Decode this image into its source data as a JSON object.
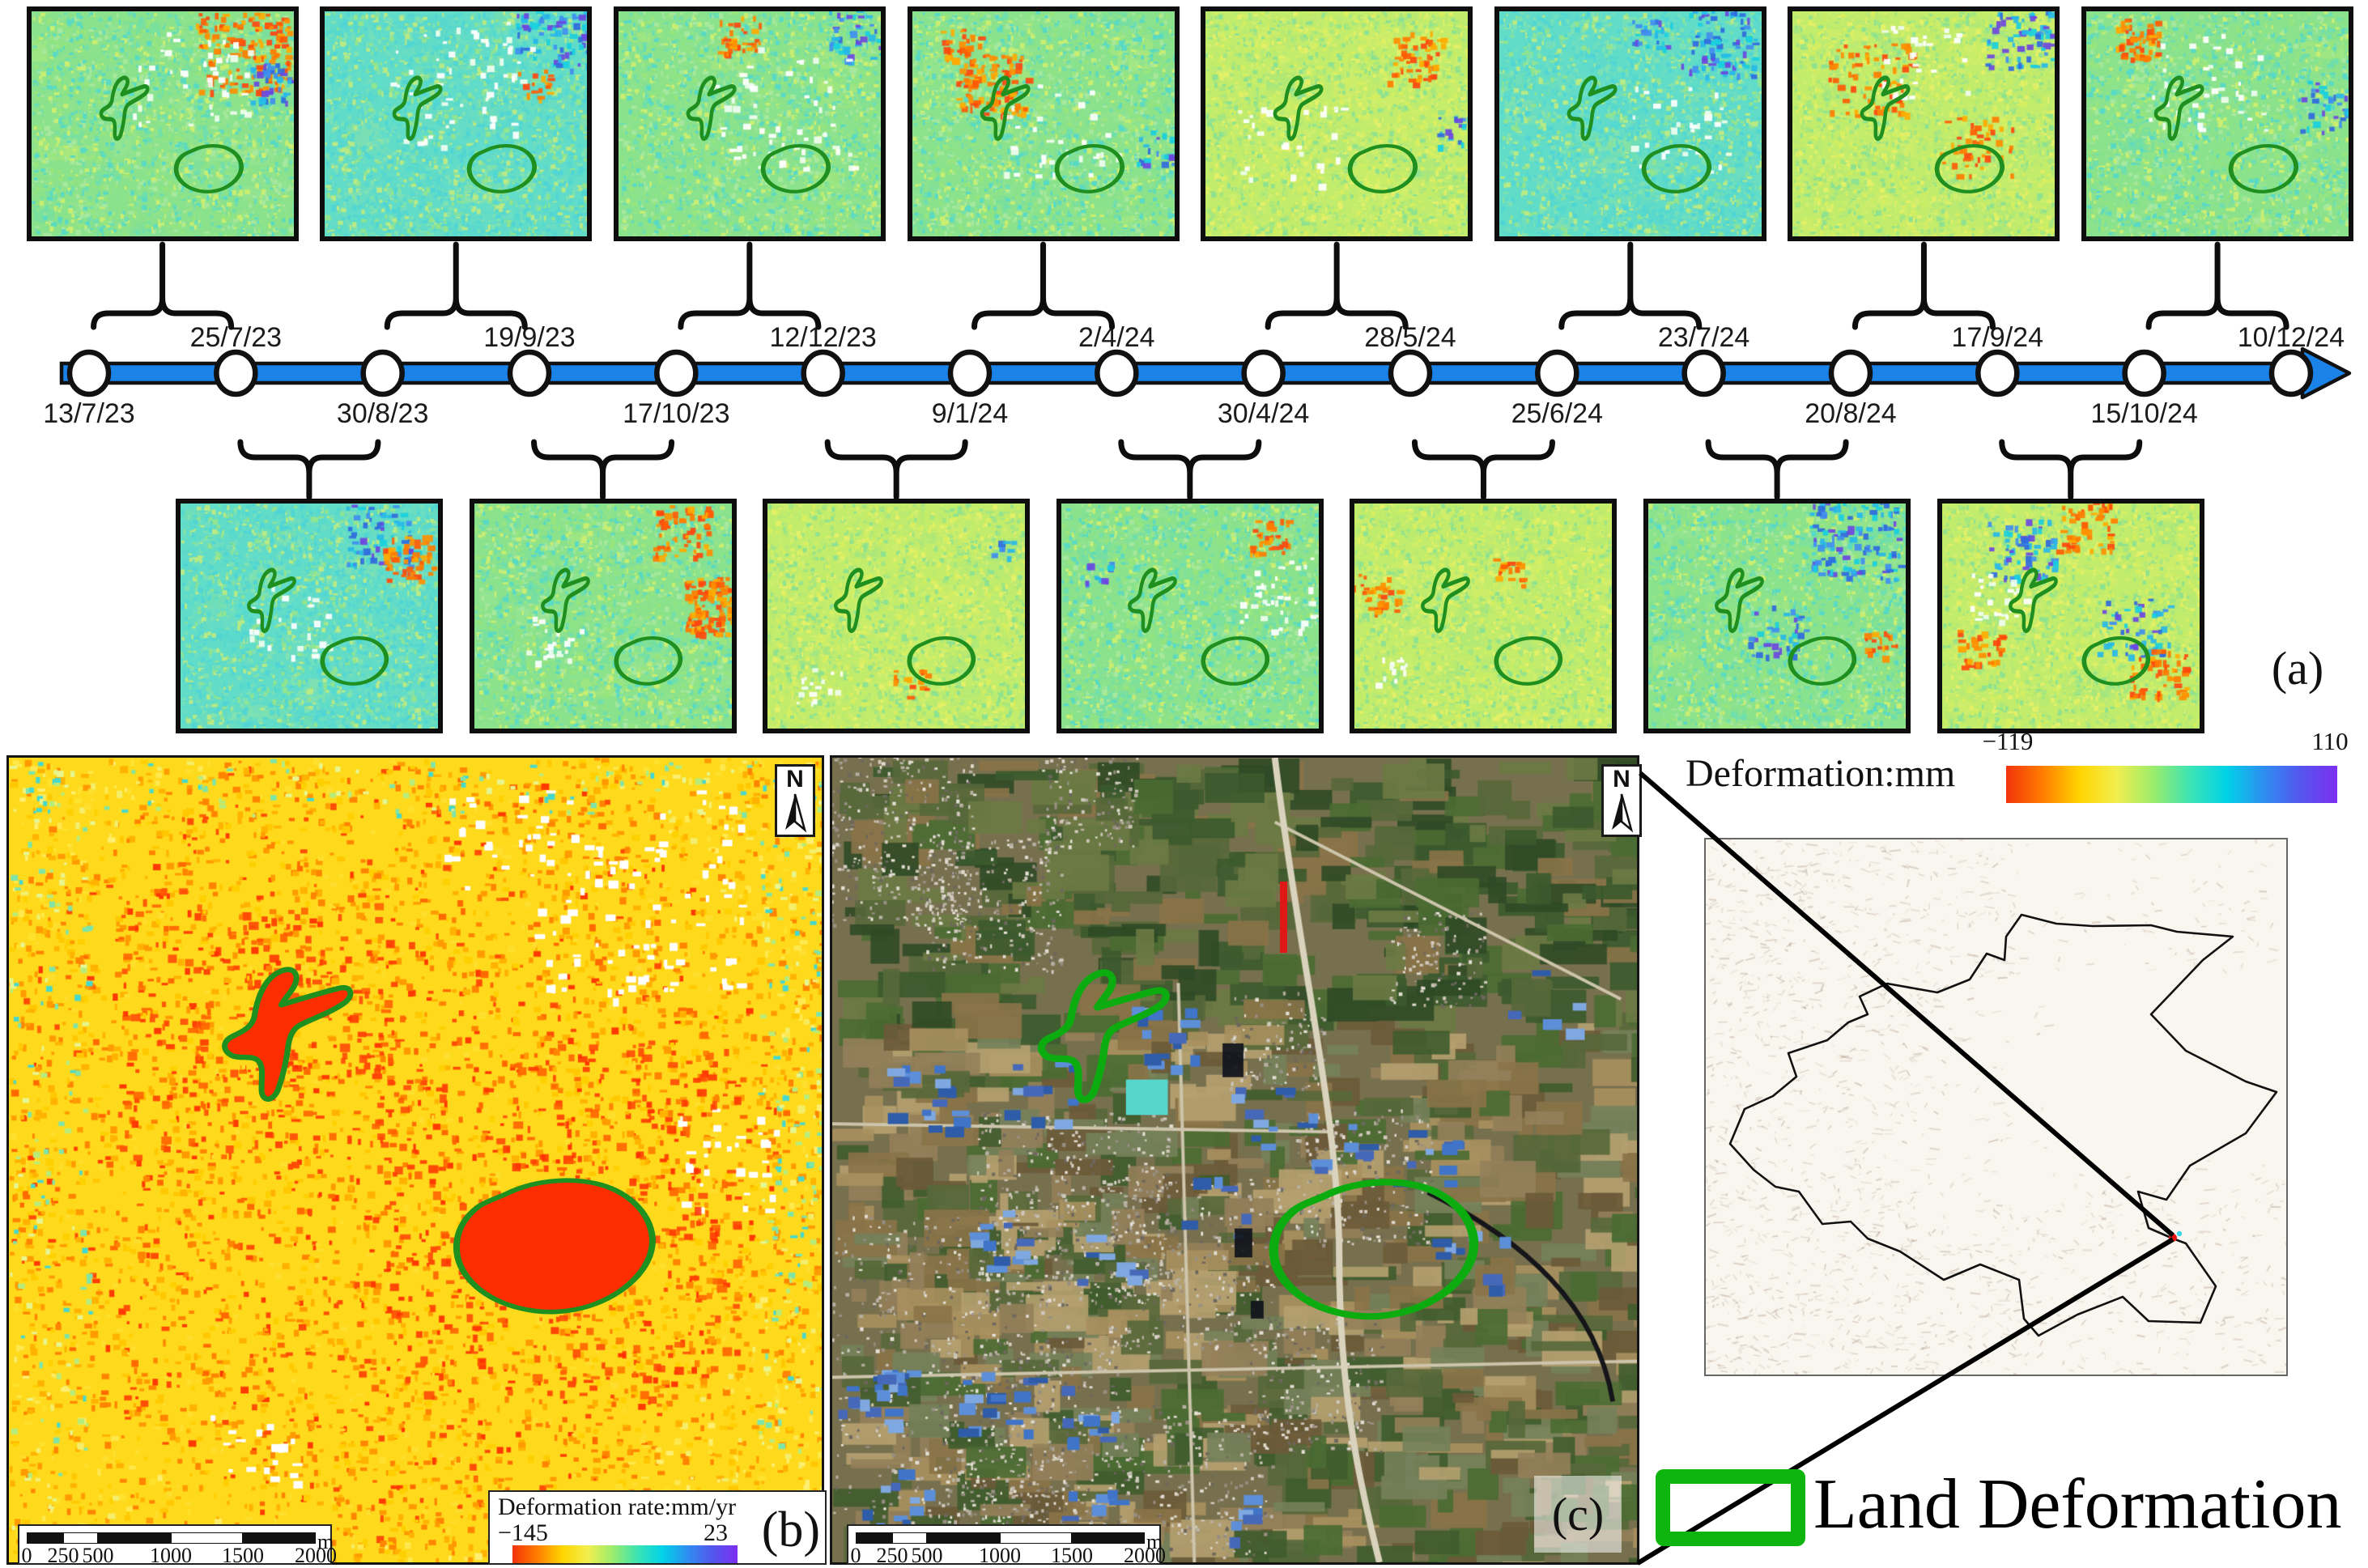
{
  "figure_labels": {
    "panel_a": "(a)",
    "panel_b": "(b)",
    "panel_c": "(c)"
  },
  "timeline": {
    "dates": [
      {
        "label": "13/7/23",
        "side": "below"
      },
      {
        "label": "25/7/23",
        "side": "above"
      },
      {
        "label": "30/8/23",
        "side": "below"
      },
      {
        "label": "19/9/23",
        "side": "above"
      },
      {
        "label": "17/10/23",
        "side": "below"
      },
      {
        "label": "12/12/23",
        "side": "above"
      },
      {
        "label": "9/1/24",
        "side": "below"
      },
      {
        "label": "2/4/24",
        "side": "above"
      },
      {
        "label": "30/4/24",
        "side": "below"
      },
      {
        "label": "28/5/24",
        "side": "above"
      },
      {
        "label": "25/6/24",
        "side": "below"
      },
      {
        "label": "23/7/24",
        "side": "above"
      },
      {
        "label": "20/8/24",
        "side": "below"
      },
      {
        "label": "17/9/24",
        "side": "above"
      },
      {
        "label": "15/10/24",
        "side": "below"
      },
      {
        "label": "10/12/24",
        "side": "above"
      }
    ]
  },
  "interferograms": {
    "top": [
      {
        "start": "13/7/23",
        "end": "25/7/23",
        "tint": "green",
        "feats": [
          [
            "warm",
            0.8,
            0.18,
            0.14,
            150
          ],
          [
            "cool",
            0.93,
            0.3,
            0.08,
            45
          ],
          [
            "white",
            0.6,
            0.28,
            0.18,
            45
          ]
        ]
      },
      {
        "start": "30/8/23",
        "end": "19/9/23",
        "tint": "cyan",
        "feats": [
          [
            "cool",
            0.86,
            0.12,
            0.11,
            70
          ],
          [
            "warm",
            0.8,
            0.32,
            0.05,
            18
          ],
          [
            "white",
            0.52,
            0.32,
            0.22,
            55
          ]
        ]
      },
      {
        "start": "17/10/23",
        "end": "12/12/23",
        "tint": "green",
        "feats": [
          [
            "warm",
            0.45,
            0.1,
            0.07,
            35
          ],
          [
            "cool",
            0.9,
            0.1,
            0.09,
            40
          ],
          [
            "white",
            0.62,
            0.42,
            0.22,
            60
          ]
        ]
      },
      {
        "start": "9/1/24",
        "end": "2/4/24",
        "tint": "green",
        "feats": [
          [
            "warm",
            0.3,
            0.32,
            0.11,
            110
          ],
          [
            "warm",
            0.18,
            0.14,
            0.06,
            30
          ],
          [
            "white",
            0.56,
            0.52,
            0.18,
            35
          ],
          [
            "cool",
            0.93,
            0.6,
            0.06,
            20
          ]
        ]
      },
      {
        "start": "30/4/24",
        "end": "28/5/24",
        "tint": "yellow",
        "feats": [
          [
            "warm",
            0.8,
            0.2,
            0.09,
            55
          ],
          [
            "cool",
            0.95,
            0.52,
            0.06,
            22
          ],
          [
            "white",
            0.32,
            0.6,
            0.16,
            30
          ]
        ]
      },
      {
        "start": "25/6/24",
        "end": "23/7/24",
        "tint": "cyan",
        "feats": [
          [
            "cool",
            0.82,
            0.14,
            0.12,
            85
          ],
          [
            "cool",
            0.58,
            0.1,
            0.06,
            25
          ],
          [
            "white",
            0.7,
            0.52,
            0.16,
            30
          ]
        ]
      },
      {
        "start": "20/8/24",
        "end": "17/9/24",
        "tint": "yellow",
        "feats": [
          [
            "cool",
            0.86,
            0.12,
            0.1,
            60
          ],
          [
            "warm",
            0.3,
            0.3,
            0.13,
            70
          ],
          [
            "warm",
            0.7,
            0.6,
            0.11,
            45
          ],
          [
            "white",
            0.5,
            0.22,
            0.13,
            30
          ]
        ]
      },
      {
        "start": "15/10/24",
        "end": "10/12/24",
        "tint": "green",
        "feats": [
          [
            "warm",
            0.2,
            0.12,
            0.07,
            55
          ],
          [
            "cool",
            0.9,
            0.42,
            0.09,
            35
          ],
          [
            "white",
            0.46,
            0.3,
            0.18,
            40
          ]
        ]
      }
    ],
    "bottom": [
      {
        "start": "25/7/23",
        "end": "30/8/23",
        "tint": "cyan",
        "feats": [
          [
            "cool",
            0.78,
            0.14,
            0.11,
            65
          ],
          [
            "warm",
            0.88,
            0.24,
            0.08,
            55
          ],
          [
            "white",
            0.42,
            0.52,
            0.13,
            25
          ]
        ]
      },
      {
        "start": "19/9/23",
        "end": "17/10/23",
        "tint": "green",
        "feats": [
          [
            "warm",
            0.94,
            0.45,
            0.1,
            150
          ],
          [
            "warm",
            0.8,
            0.12,
            0.09,
            60
          ],
          [
            "white",
            0.3,
            0.6,
            0.09,
            20
          ]
        ]
      },
      {
        "start": "12/12/23",
        "end": "9/1/24",
        "tint": "yellow",
        "feats": [
          [
            "warm",
            0.55,
            0.8,
            0.05,
            16
          ],
          [
            "white",
            0.2,
            0.8,
            0.07,
            16
          ],
          [
            "cool",
            0.9,
            0.2,
            0.04,
            10
          ]
        ]
      },
      {
        "start": "2/4/24",
        "end": "30/4/24",
        "tint": "green",
        "feats": [
          [
            "warm",
            0.8,
            0.14,
            0.06,
            35
          ],
          [
            "white",
            0.85,
            0.4,
            0.13,
            40
          ],
          [
            "cool",
            0.14,
            0.3,
            0.04,
            12
          ]
        ]
      },
      {
        "start": "28/5/24",
        "end": "25/6/24",
        "tint": "yellow",
        "feats": [
          [
            "warm",
            0.08,
            0.4,
            0.07,
            35
          ],
          [
            "warm",
            0.6,
            0.3,
            0.05,
            18
          ],
          [
            "white",
            0.14,
            0.74,
            0.05,
            12
          ]
        ]
      },
      {
        "start": "23/7/24",
        "end": "20/8/24",
        "tint": "green",
        "feats": [
          [
            "cool",
            0.8,
            0.16,
            0.14,
            110
          ],
          [
            "cool",
            0.5,
            0.56,
            0.09,
            35
          ],
          [
            "warm",
            0.9,
            0.62,
            0.05,
            20
          ]
        ]
      },
      {
        "start": "17/9/24",
        "end": "15/10/24",
        "tint": "yellow",
        "feats": [
          [
            "cool",
            0.3,
            0.2,
            0.11,
            65
          ],
          [
            "cool",
            0.74,
            0.56,
            0.11,
            55
          ],
          [
            "warm",
            0.55,
            0.1,
            0.09,
            55
          ],
          [
            "warm",
            0.84,
            0.76,
            0.09,
            55
          ],
          [
            "warm",
            0.14,
            0.64,
            0.07,
            35
          ],
          [
            "white",
            0.22,
            0.42,
            0.09,
            25
          ]
        ]
      }
    ]
  },
  "main_colorbar": {
    "title": "Deformation:mm",
    "min_label": "−119",
    "max_label": "110"
  },
  "panel_b": {
    "north_label": "N",
    "legend_title": "Deformation rate:mm/yr",
    "min_label": "−145",
    "max_label": "23",
    "scalebar_ticks": [
      "0",
      "250",
      "500",
      "1000",
      "1500",
      "2000"
    ],
    "scalebar_unit": "m"
  },
  "panel_c": {
    "north_label": "N",
    "scalebar_ticks": [
      "0",
      "250",
      "500",
      "1000",
      "1500",
      "2000"
    ],
    "scalebar_unit": "m"
  },
  "location_legend": {
    "label": "Land Deformation"
  },
  "colors": {
    "timeline_blue": "#1b82e8",
    "outline_green": "#1f8f1f",
    "outline_green_bright": "#0cab10",
    "legend_green": "#0fb50f",
    "colormap": [
      "#f2330a",
      "#ff7e00",
      "#ffd500",
      "#f2ee4e",
      "#9cec6c",
      "#3ce4b4",
      "#00d2e8",
      "#2e8ef0",
      "#5456ee",
      "#7c2ff0"
    ]
  }
}
